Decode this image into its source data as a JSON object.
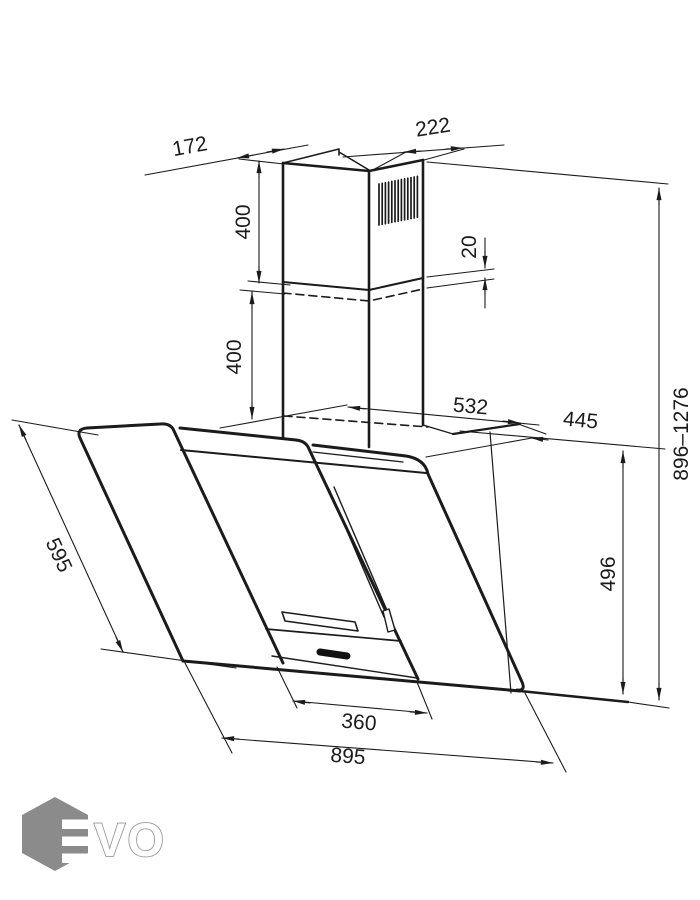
{
  "drawing": {
    "dims": {
      "chimney_depth": "172",
      "chimney_width": "222",
      "upper_duct_height": "400",
      "duct_overlap": "20",
      "lower_duct_height": "400",
      "bracket_width": "532",
      "top_depth": "445",
      "height_range": "896–1276",
      "glass_slant_length": "595",
      "right_side_height": "496",
      "handle_width": "360",
      "overall_width": "895"
    },
    "logo": {
      "vo_text": "VO",
      "hex_color": "#8b8b8b"
    },
    "line_color": "#1b1b1b",
    "background": "#ffffff"
  }
}
